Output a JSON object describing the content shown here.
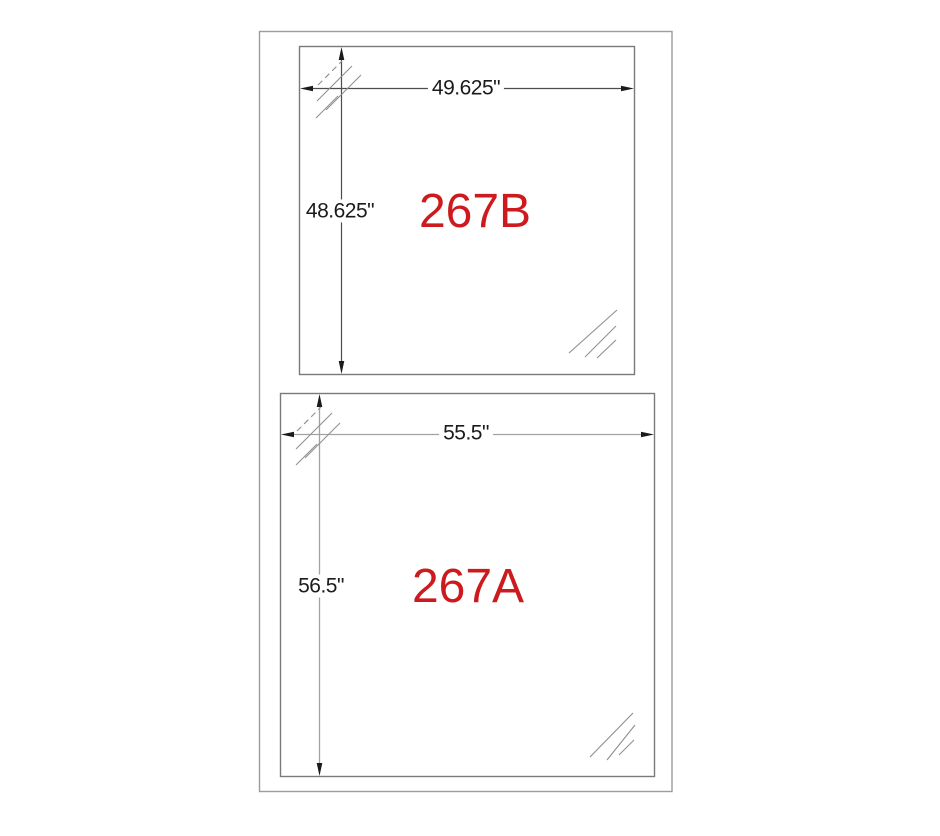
{
  "panels": [
    {
      "label": "267B",
      "width_label": "49.625\"",
      "height_label": "48.625\""
    },
    {
      "label": "267A",
      "width_label": "55.5\"",
      "height_label": "56.5\""
    }
  ],
  "colors": {
    "panel_label_red": "#cd1a1f",
    "dim_text": "#1b1b1b",
    "dim_line_dark": "#4d4d4d",
    "dim_line_light": "#a2a2a2",
    "panel_border": "#7a7a7a",
    "outer_border": "#9c9c9c",
    "hatch_gray": "#8f8f8f",
    "arrow_black": "#1a1a1a",
    "background": "#ffffff"
  }
}
